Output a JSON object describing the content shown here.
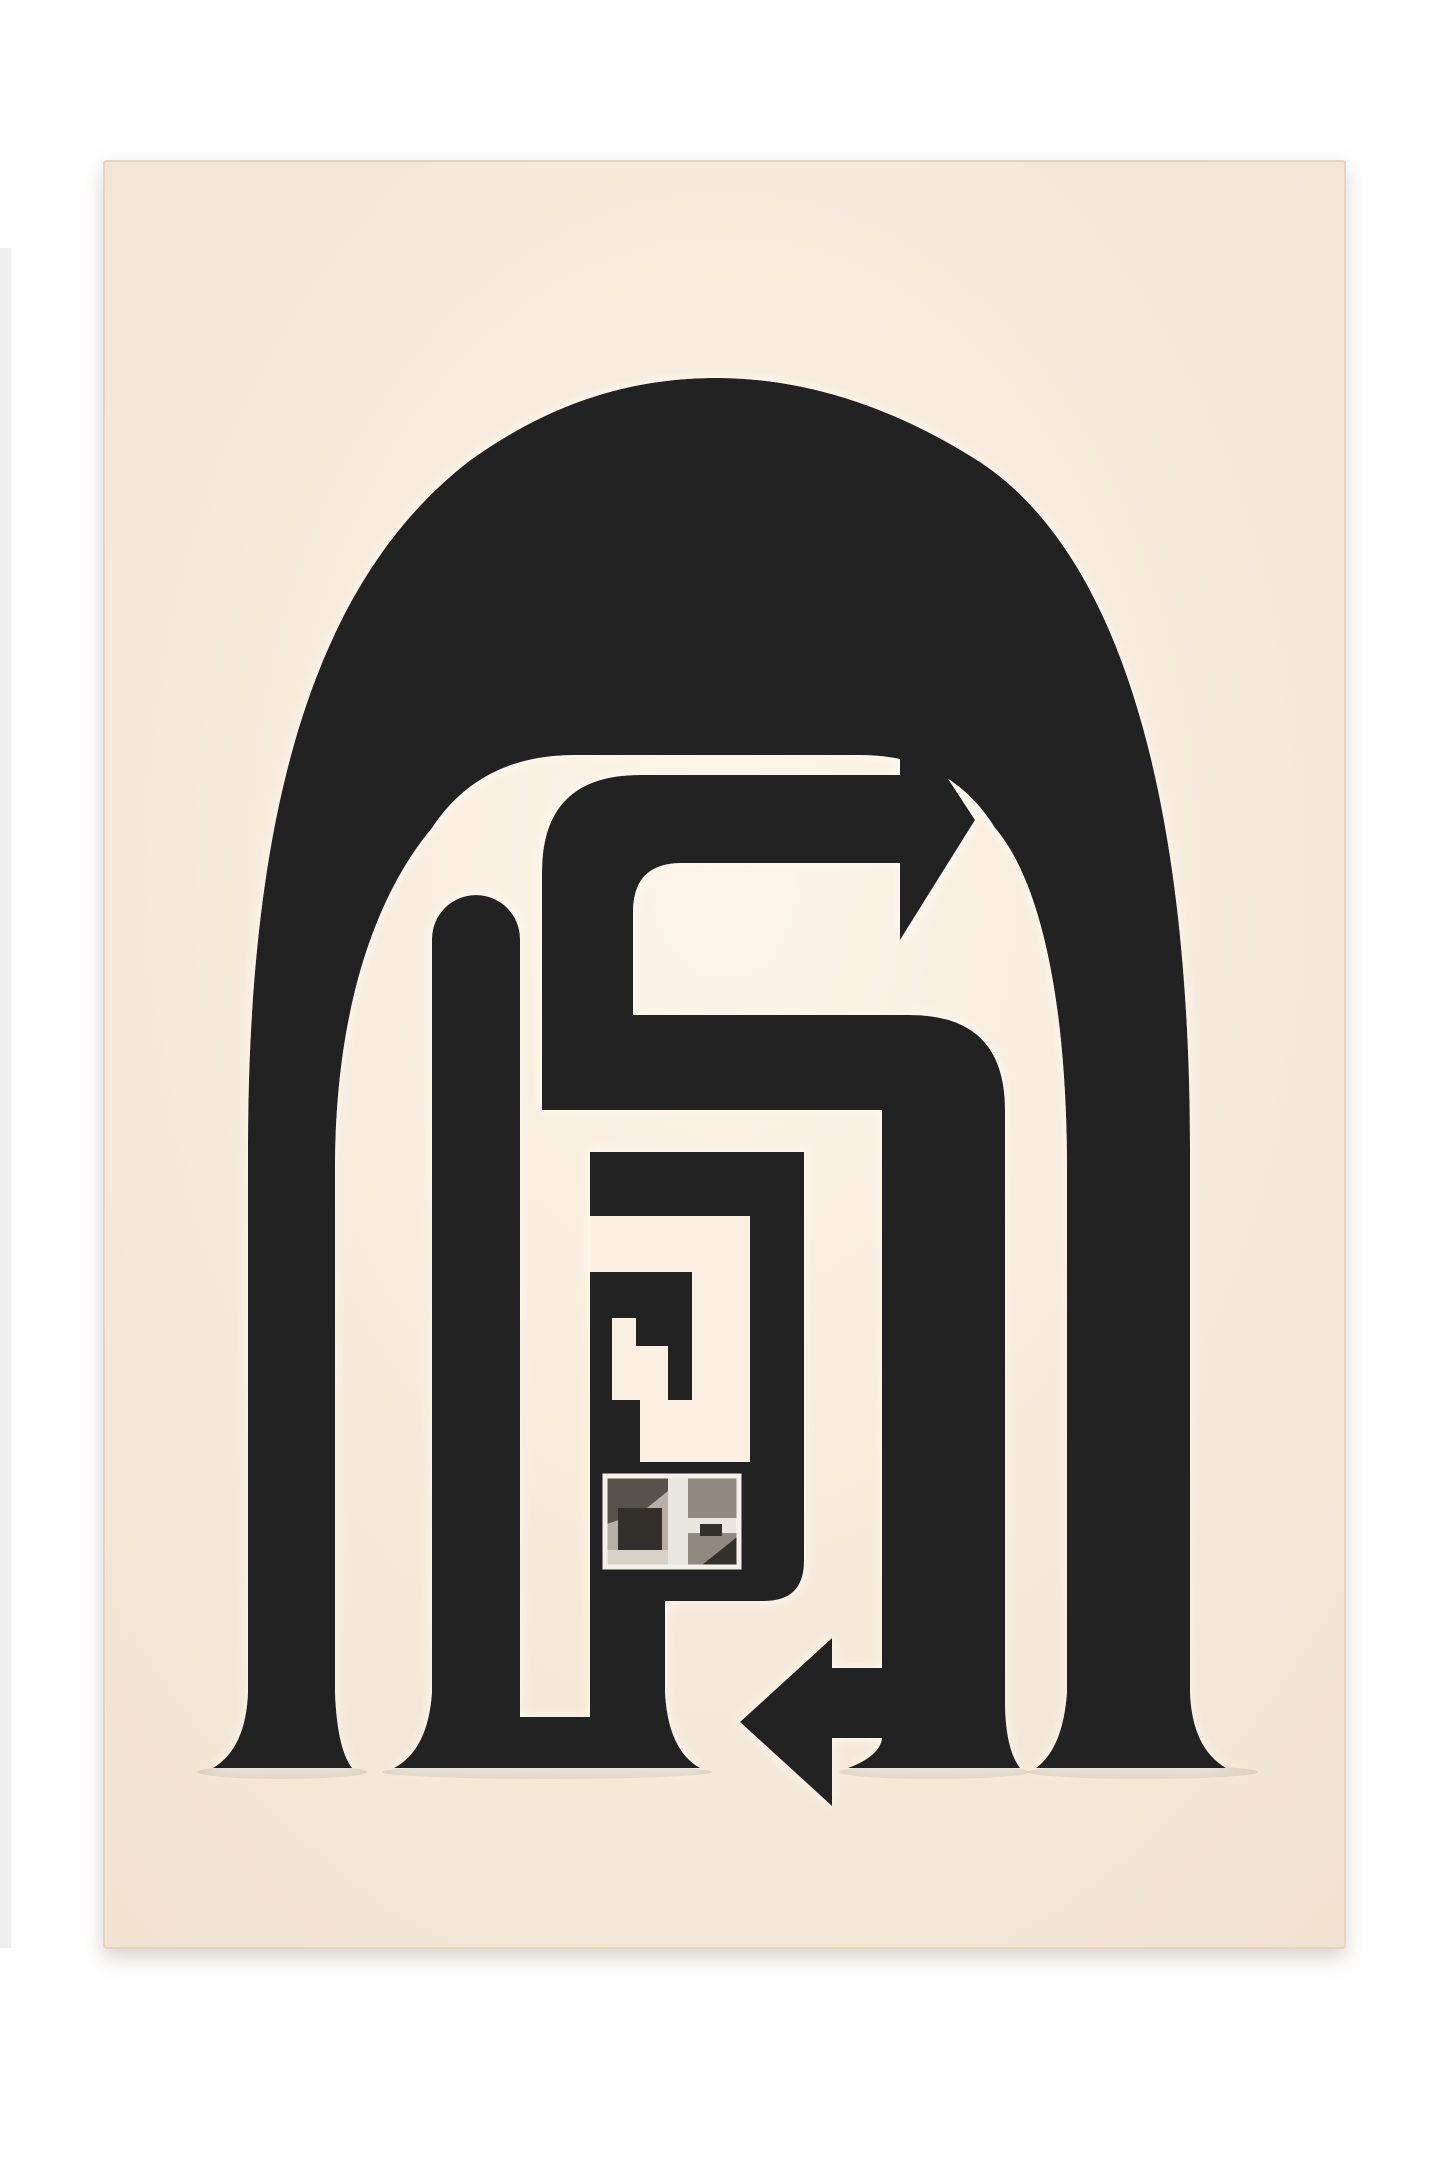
{
  "artwork": {
    "kind": "photographed-art-print",
    "subject": "black arch labyrinth with arrows and photo collage chip on cream paper",
    "palette": {
      "background": "#ffffff",
      "background_strip": "#efefef",
      "paper": "#f6e9da",
      "paper_highlight": "#fdf5e8",
      "paper_low": "#f1e2d0",
      "paper_edge": "#e3d5c1",
      "paper_carve": "#faefe0",
      "paper_shadow": "#b9b0a2",
      "ink": "#242021",
      "halo": "#fffdf4",
      "photo_frame": "#f4f1ea",
      "photo_base": "#b6afa5",
      "photo_dark": "#57534b",
      "photo_deep": "#332f2a",
      "photo_mid": "#8f8980",
      "photo_light": "#e9e6de",
      "photo_floor": "#d8d2c6"
    }
  }
}
